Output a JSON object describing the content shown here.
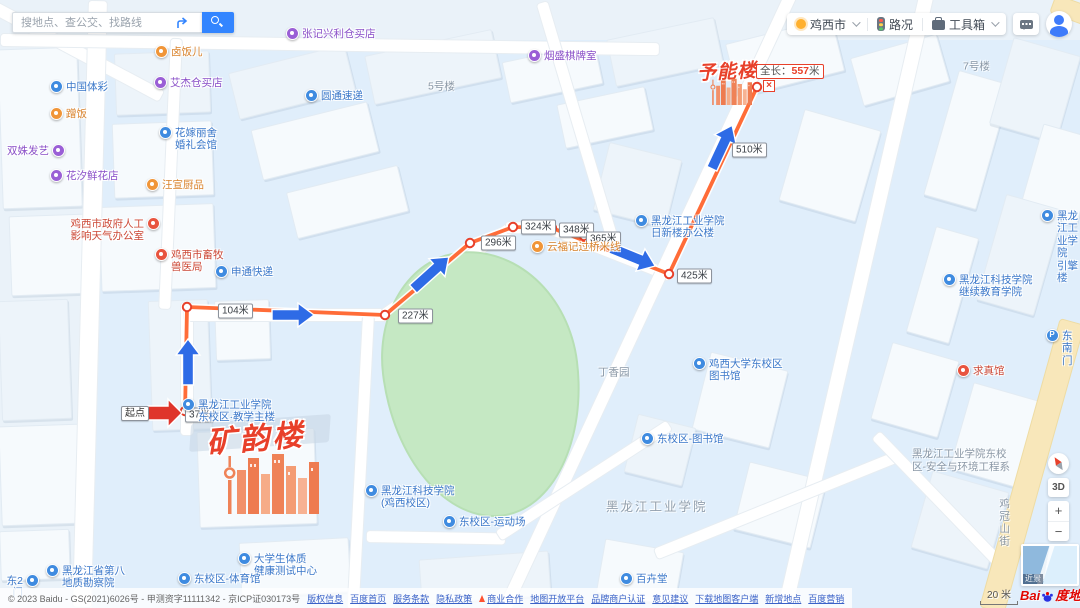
{
  "search": {
    "placeholder": "搜地点、查公交、找路线"
  },
  "toolbar": {
    "city": "鸡西市",
    "traffic_label": "路况",
    "toolbox_label": "工具箱"
  },
  "route": {
    "start_label": "起点",
    "origin_building": "矿韵楼",
    "destination_building": "予能楼",
    "total_prefix": "全长：",
    "total_value": "557",
    "total_unit": "米",
    "total_m": 557,
    "close_glyph": "×",
    "milestones": [
      {
        "text": "37米",
        "x": 185,
        "y": 415
      },
      {
        "text": "104米",
        "x": 218,
        "y": 311
      },
      {
        "text": "227米",
        "x": 398,
        "y": 316
      },
      {
        "text": "296米",
        "x": 481,
        "y": 243
      },
      {
        "text": "324米",
        "x": 521,
        "y": 227
      },
      {
        "text": "348米",
        "x": 559,
        "y": 230
      },
      {
        "text": "365米",
        "x": 586,
        "y": 239
      },
      {
        "text": "425米",
        "x": 677,
        "y": 276
      },
      {
        "text": "510米",
        "x": 732,
        "y": 150
      }
    ],
    "path": [
      [
        185,
        413
      ],
      [
        187,
        307
      ],
      [
        385,
        315
      ],
      [
        470,
        243
      ],
      [
        513,
        227
      ],
      [
        552,
        228
      ],
      [
        669,
        274
      ],
      [
        757,
        87
      ]
    ],
    "nodes": [
      [
        185,
        411
      ],
      [
        187,
        307
      ],
      [
        385,
        315
      ],
      [
        470,
        243
      ],
      [
        513,
        227
      ],
      [
        552,
        228
      ],
      [
        584,
        236
      ],
      [
        669,
        274
      ],
      [
        757,
        87
      ]
    ],
    "arrows": [
      {
        "x": 165,
        "y": 413,
        "angle": 90,
        "len": 34,
        "color": "red"
      },
      {
        "x": 188,
        "y": 362,
        "angle": 0,
        "len": 46,
        "color": "blue"
      },
      {
        "x": 293,
        "y": 315,
        "angle": 90,
        "len": 42,
        "color": "blue"
      },
      {
        "x": 431,
        "y": 273,
        "angle": 48,
        "len": 48,
        "color": "blue"
      },
      {
        "x": 633,
        "y": 257,
        "angle": 112,
        "len": 48,
        "color": "blue"
      },
      {
        "x": 722,
        "y": 147,
        "angle": 25,
        "len": 48,
        "color": "blue"
      }
    ]
  },
  "pois": [
    {
      "name": "中国体彩",
      "color": "blue",
      "x": 57,
      "y": 88,
      "side": "right"
    },
    {
      "name": "蹭饭",
      "color": "orange",
      "x": 57,
      "y": 115,
      "side": "right"
    },
    {
      "name": "双姝发艺",
      "color": "purple",
      "x": 58,
      "y": 152,
      "side": "left"
    },
    {
      "name": "花汐鲜花店",
      "color": "purple",
      "x": 57,
      "y": 177,
      "side": "right"
    },
    {
      "name": "卤饭儿",
      "color": "orange",
      "x": 162,
      "y": 53,
      "side": "right"
    },
    {
      "name": "艾杰仓买店",
      "color": "purple",
      "x": 161,
      "y": 84,
      "side": "right"
    },
    {
      "name": "花嫁丽舍\n婚礼会馆",
      "color": "blue",
      "x": 166,
      "y": 134,
      "side": "right"
    },
    {
      "name": "汪宣厨品",
      "color": "orange",
      "x": 153,
      "y": 186,
      "side": "right"
    },
    {
      "name": "鸡西市政府人工\n影响天气办公室",
      "color": "red",
      "x": 153,
      "y": 225,
      "side": "left"
    },
    {
      "name": "鸡西市畜牧\n兽医局",
      "color": "red",
      "x": 162,
      "y": 256,
      "side": "right"
    },
    {
      "name": "申通快递",
      "color": "blue",
      "x": 222,
      "y": 273,
      "side": "right"
    },
    {
      "name": "张记兴利仓买店",
      "color": "purple",
      "x": 293,
      "y": 35,
      "side": "right"
    },
    {
      "name": "圆通速递",
      "color": "blue",
      "x": 312,
      "y": 97,
      "side": "right"
    },
    {
      "name": "烟盛棋牌室",
      "color": "purple",
      "x": 535,
      "y": 57,
      "side": "right"
    },
    {
      "name": "云福记过桥米线",
      "color": "orange",
      "x": 538,
      "y": 248,
      "side": "right"
    },
    {
      "name": "黑龙江工业学院\n日新楼办公楼",
      "color": "blue",
      "x": 642,
      "y": 222,
      "side": "right"
    },
    {
      "name": "黑龙江工业学院\n东校区·教学主楼",
      "color": "blue",
      "x": 189,
      "y": 406,
      "side": "right"
    },
    {
      "name": "鸡西大学东校区\n图书馆",
      "color": "blue",
      "x": 700,
      "y": 365,
      "side": "right"
    },
    {
      "name": "东校区-图书馆",
      "color": "blue",
      "x": 648,
      "y": 440,
      "side": "right"
    },
    {
      "name": "黑龙江科技学院\n继续教育学院",
      "color": "blue",
      "x": 950,
      "y": 281,
      "side": "right"
    },
    {
      "name": "黑龙江工业学院\n引擎楼",
      "color": "blue",
      "x": 1048,
      "y": 217,
      "side": "right"
    },
    {
      "name": "求真馆",
      "color": "red",
      "x": 964,
      "y": 372,
      "side": "right"
    },
    {
      "name": "东南门",
      "color": "blue",
      "x": 1053,
      "y": 337,
      "side": "right",
      "glyph": "P"
    },
    {
      "name": "黑龙江科技学院\n(鸡西校区)",
      "color": "blue",
      "x": 372,
      "y": 492,
      "side": "right"
    },
    {
      "name": "东校区-运动场",
      "color": "blue",
      "x": 450,
      "y": 523,
      "side": "right"
    },
    {
      "name": "百卉堂",
      "color": "blue",
      "x": 627,
      "y": 580,
      "side": "right"
    },
    {
      "name": "大学生体质\n健康测试中心",
      "color": "blue",
      "x": 245,
      "y": 560,
      "side": "right"
    },
    {
      "name": "东校区-体育馆",
      "color": "blue",
      "x": 185,
      "y": 580,
      "side": "right"
    },
    {
      "name": "黑龙江省第八\n地质勘察院",
      "color": "blue",
      "x": 53,
      "y": 572,
      "side": "right"
    },
    {
      "name": "东2门",
      "color": "blue",
      "x": 32,
      "y": 582,
      "side": "left"
    }
  ],
  "area_labels": [
    {
      "text": "5号楼",
      "x": 428,
      "y": 87
    },
    {
      "text": "7号楼",
      "x": 963,
      "y": 67
    },
    {
      "text": "丁香园",
      "x": 598,
      "y": 373
    },
    {
      "text": "黑龙江工业学院",
      "x": 606,
      "y": 508,
      "big": true
    },
    {
      "text": "黑龙江工业学院东校\n区-安全与环境工程系",
      "x": 912,
      "y": 461
    },
    {
      "text": "鸡冠山街",
      "x": 997,
      "y": 498,
      "vertical": true
    }
  ],
  "map_controls": {
    "threed": "3D",
    "zoom_in": "+",
    "zoom_out": "−",
    "minimap_label": "近景"
  },
  "scale_bar": {
    "label": "20 米"
  },
  "logo": {
    "bai": "Bai",
    "suffix": "度地图"
  },
  "footer": {
    "copyright": "© 2023 Baidu - GS(2021)6026号 - 甲测资字11111342 - 京ICP证030173号",
    "links": [
      "版权信息",
      "百度首页",
      "服务条款",
      "隐私政策",
      "商业合作",
      "地图开放平台",
      "品牌商户认证",
      "意见建议",
      "下载地图客户端",
      "新增地点",
      "百度营销"
    ],
    "hot_link_index": 4
  },
  "colors": {
    "route": "#ff6c38",
    "arrow_blue": "#2e6be6",
    "arrow_red": "#df352b",
    "accent_red": "#e8402a",
    "search_blue": "#3385ff",
    "field_green": "#c5e8c3",
    "poi_icon": {
      "blue": "#3f8be0",
      "purple": "#9a5fd6",
      "orange": "#f09538",
      "red": "#e8543f"
    },
    "poi_text": {
      "blue": "#3a77c9",
      "purple": "#8a4fc8",
      "orange": "#d9822b",
      "red": "#cc4836"
    }
  }
}
